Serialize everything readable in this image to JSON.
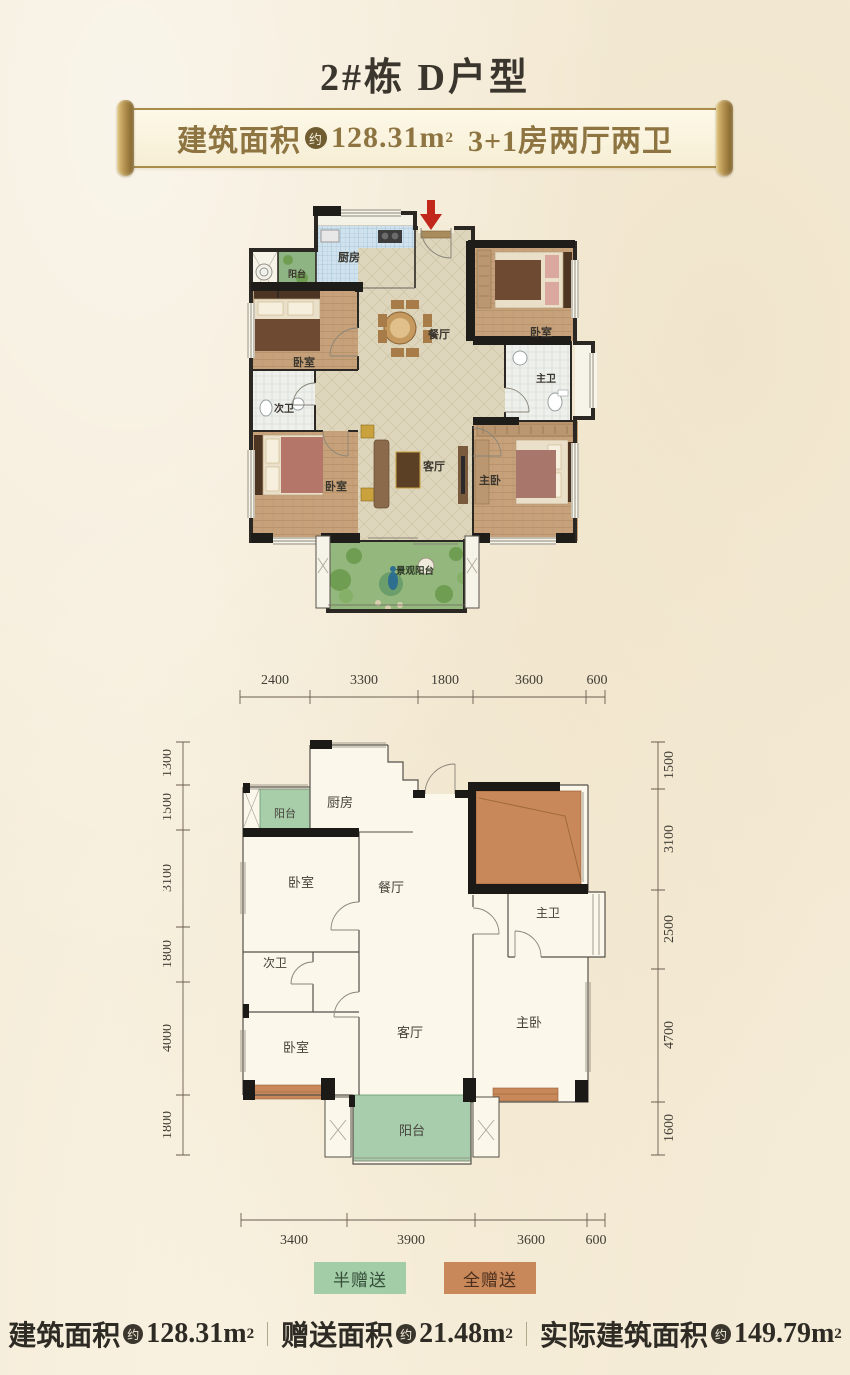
{
  "page": {
    "title": "2#栋 D户型",
    "background": "#f5ecd8"
  },
  "banner": {
    "label": "建筑面积",
    "approx": "约",
    "value": "128.31m",
    "sup": "2",
    "rooms": "3+1房两厅两卫",
    "border_gold": "#a98c4a",
    "text_gold": "#8d7440"
  },
  "render_plan": {
    "labels": {
      "balcony_top": "阳台",
      "kitchen": "厨房",
      "bedroom_left": "卧室",
      "bath_second": "次卫",
      "bedroom_bottom": "卧室",
      "dining": "餐厅",
      "living": "客厅",
      "bedroom_right": "卧室",
      "bath_master": "主卫",
      "master": "主卧",
      "view_balcony": "景观阳台"
    },
    "entry_arrow_color": "#c1271b"
  },
  "schematic": {
    "labels": {
      "balcony_top": "阳台",
      "kitchen": "厨房",
      "bedroom_left": "卧室",
      "bath_second": "次卫",
      "bedroom_bottom": "卧室",
      "dining": "餐厅",
      "living": "客厅",
      "bath_master": "主卫",
      "master": "主卧",
      "balcony_bottom": "阳台"
    },
    "dims": {
      "top": [
        "2400",
        "3300",
        "1800",
        "3600",
        "600"
      ],
      "bottom": [
        "3400",
        "3900",
        "3600",
        "600"
      ],
      "left": [
        "1300",
        "1500",
        "3100",
        "1800",
        "4000",
        "1800"
      ],
      "right": [
        "1500",
        "3100",
        "2500",
        "4700",
        "1600"
      ]
    },
    "half_gift_color": "#a7cda9",
    "full_gift_color": "#c8885a"
  },
  "legend": {
    "half": {
      "label": "半赠送",
      "color": "#a3cda6"
    },
    "full": {
      "label": "全赠送",
      "color": "#c8885a"
    }
  },
  "summary": {
    "items": [
      {
        "label": "建筑面积",
        "approx": "约",
        "value": "128.31m",
        "sup": "2"
      },
      {
        "label": "赠送面积",
        "approx": "约",
        "value": "21.48m",
        "sup": "2"
      },
      {
        "label": "实际建筑面积",
        "approx": "约",
        "value": "149.79m",
        "sup": "2"
      }
    ]
  }
}
